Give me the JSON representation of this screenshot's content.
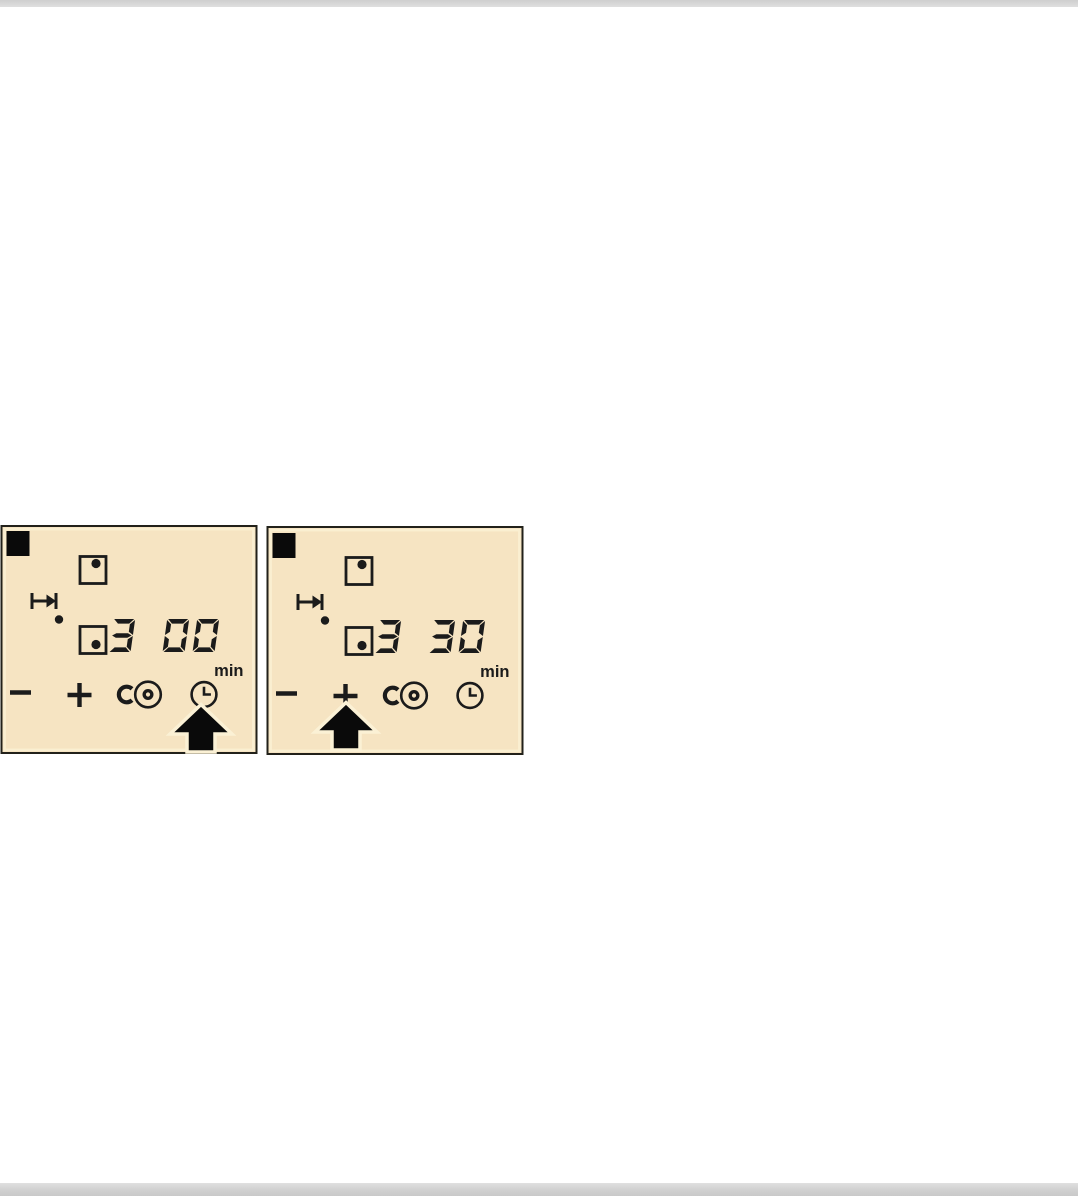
{
  "page": {
    "content": "appliance manual figure: two hob control panel illustrations"
  },
  "colors": {
    "page_bg": "#ffffff",
    "rule_gray": "#d3d3d3",
    "panel_bg": "#f6e4c2",
    "panel_border": "#22211a",
    "ink": "#1b1b1b",
    "arrow_halo": "#fbf1d5"
  },
  "panels": [
    {
      "display": "3 00",
      "unit": "min",
      "pressed_control": "timer-clock-button",
      "icons": [
        "step-marker",
        "rear-cooking-zone-icon",
        "arrow-to-limit-icon",
        "indicator-dot",
        "front-cooking-zone-icon",
        "minus-button-icon",
        "plus-button-icon",
        "key-lock-button-icon",
        "timer-clock-button-icon",
        "press-arrow"
      ]
    },
    {
      "display": "3 30",
      "unit": "min",
      "pressed_control": "plus-button",
      "icons": [
        "step-marker",
        "rear-cooking-zone-icon",
        "arrow-to-limit-icon",
        "indicator-dot",
        "front-cooking-zone-icon",
        "minus-button-icon",
        "plus-button-icon",
        "key-lock-button-icon",
        "timer-clock-button-icon",
        "press-arrow"
      ]
    }
  ]
}
